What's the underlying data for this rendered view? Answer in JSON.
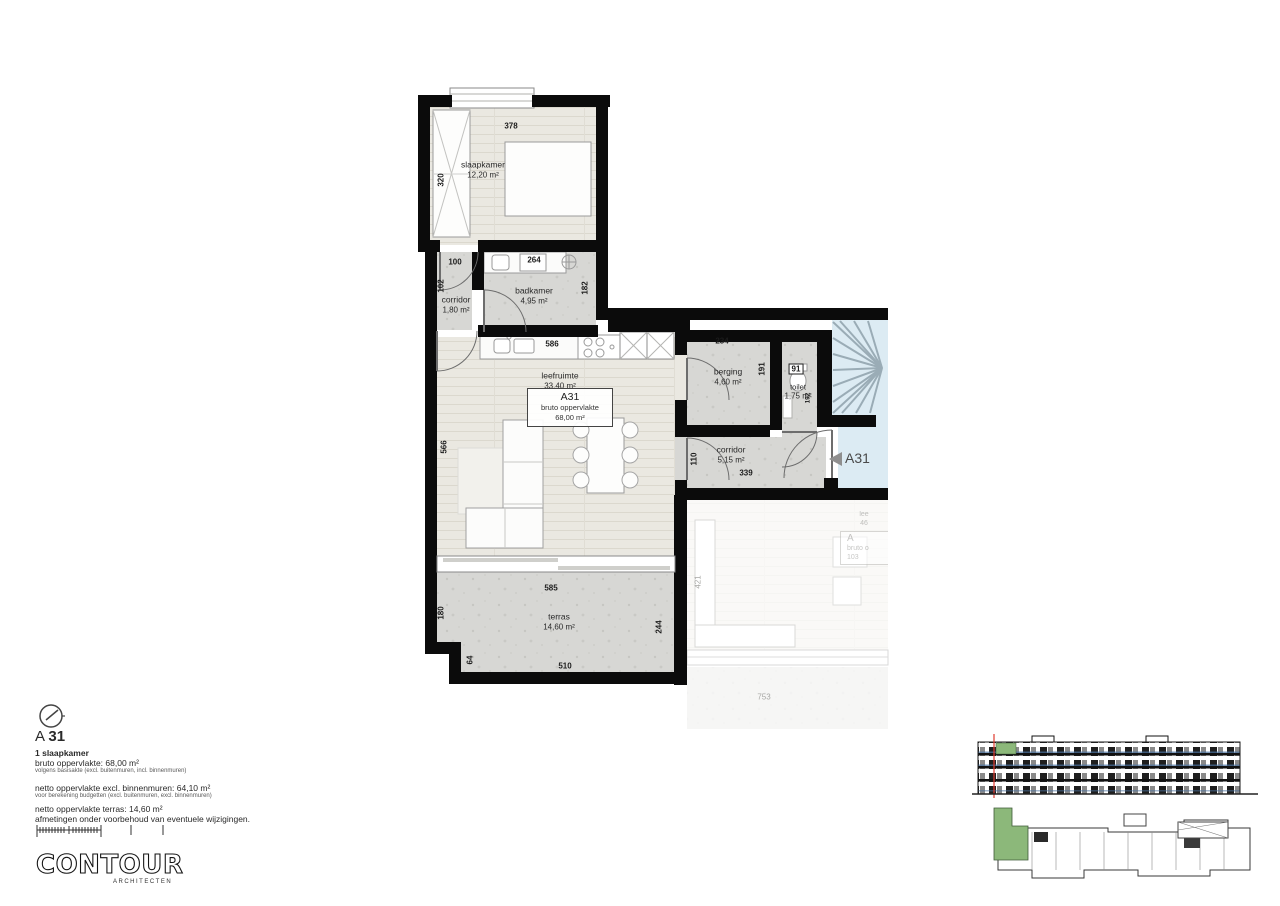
{
  "plan": {
    "rooms": {
      "slaapkamer": {
        "label": "slaapkamer",
        "area": "12,20 m²"
      },
      "corridor1": {
        "label": "corridor",
        "area": "1,80 m²"
      },
      "badkamer": {
        "label": "badkamer",
        "area": "4,95 m²"
      },
      "leefruimte": {
        "label": "leefruimte",
        "area": "33,40 m²"
      },
      "berging": {
        "label": "berging",
        "area": "4,60 m²"
      },
      "toilet": {
        "label": "toilet",
        "area": "1,75 m²"
      },
      "corridor2": {
        "label": "corridor",
        "area": "5,15 m²"
      },
      "terras": {
        "label": "terras",
        "area": "14,60 m²"
      }
    },
    "unit_box": {
      "code": "A31",
      "line": "bruto oppervlakte",
      "area": "68,00 m²"
    },
    "entrance_label": "A31",
    "dims": {
      "slaapkamer_top": "378",
      "slaapkamer_left": "320",
      "corridor1_top": "100",
      "corridor1_left": "102",
      "badkamer_top": "264",
      "badkamer_right": "182",
      "kitchen": "586",
      "leefruimte_left": "566",
      "berging_top": "234",
      "berging_right": "191",
      "toilet_top": "91",
      "toilet_right": "192",
      "corridor2_left": "110",
      "corridor2_bottom": "339",
      "terras_top": "585",
      "terras_left": "180",
      "terras_right": "244",
      "terras_bottom": "510",
      "terras_step": "64",
      "neighbor_left": "421",
      "neighbor_bottom": "753"
    },
    "neighbor": {
      "partial_line1": "lee",
      "partial_line2": "46",
      "partial_code": "A",
      "partial_line3": "bruto o",
      "partial_line4": "103"
    }
  },
  "info": {
    "title": {
      "prefix": "A ",
      "number": "31"
    },
    "subtitle": "1 slaapkamer",
    "rows": [
      {
        "text": "bruto oppervlakte: 68,00 m²"
      },
      {
        "text": "volgens basisakte (excl. buitenmuren, incl. binnenmuren)"
      },
      {
        "text": "netto oppervlakte excl. binnenmuren: 64,10 m²"
      },
      {
        "text": "voor berekening budgetten (excl. buitenmuren, excl. binnenmuren)"
      },
      {
        "text": "netto oppervlakte terras: 14,60 m²"
      },
      {
        "text": "afmetingen onder voorbehoud van eventuele wijzigingen."
      }
    ]
  },
  "logo": {
    "name": "CONTOUR",
    "sub": "ARCHITECTEN"
  },
  "colors": {
    "wall": "#0b0b0b",
    "wood_floor": "#eae8e1",
    "concrete_floor": "#d7d7d4",
    "stair_blue": "#dcebf3",
    "unit_green": "#8cb87a",
    "marker_red": "#e03a2f",
    "arrow_grey": "#8f8f8f"
  }
}
